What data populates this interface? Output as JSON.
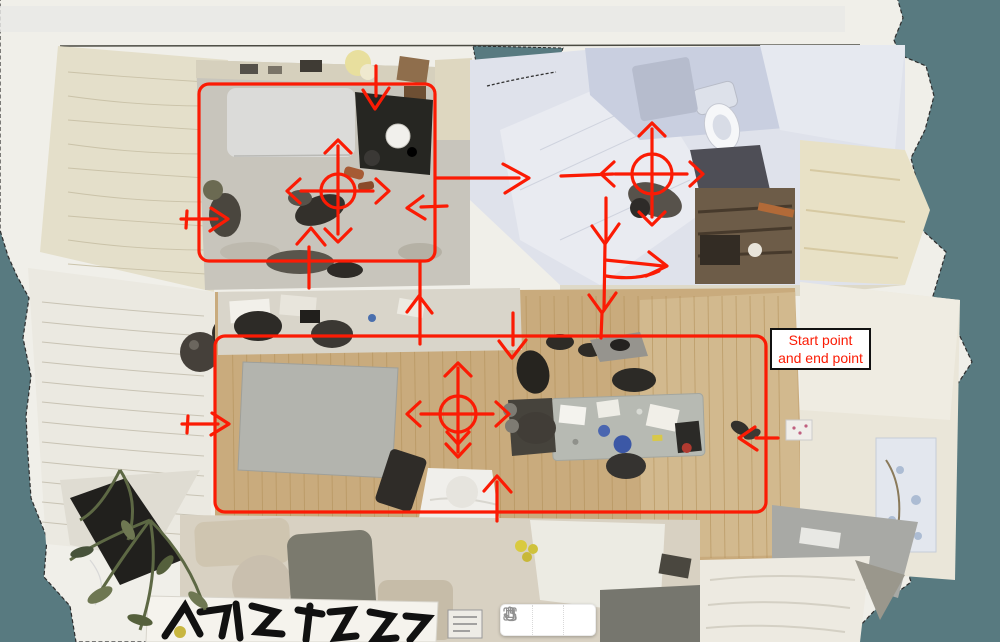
{
  "scene": {
    "name": "apartment-top-down-3d-scan",
    "background_color": "#587a80",
    "scan_base_color": "#f0efe9"
  },
  "annotation": {
    "color": "#fb1b04",
    "label": {
      "line1": "Start point",
      "line2": "and end point",
      "text_color": "#fb1b04",
      "background": "#ffffff",
      "border_color": "#111111"
    },
    "markers": [
      {
        "name": "upper-room-crosshair",
        "cx": 338,
        "cy": 191,
        "r": 17,
        "double_down": false
      },
      {
        "name": "hallway-crosshair",
        "cx": 652,
        "cy": 174,
        "r": 20,
        "double_down": false
      },
      {
        "name": "main-room-crosshair",
        "cx": 458,
        "cy": 414,
        "r": 18,
        "double_down": true
      }
    ]
  },
  "toolbar": {
    "buttons": [
      {
        "name": "fit-view",
        "icon": "fit-view-icon"
      },
      {
        "name": "pan",
        "icon": "pan-hand-icon"
      },
      {
        "name": "select",
        "icon": "pointer-hand-icon"
      }
    ]
  }
}
